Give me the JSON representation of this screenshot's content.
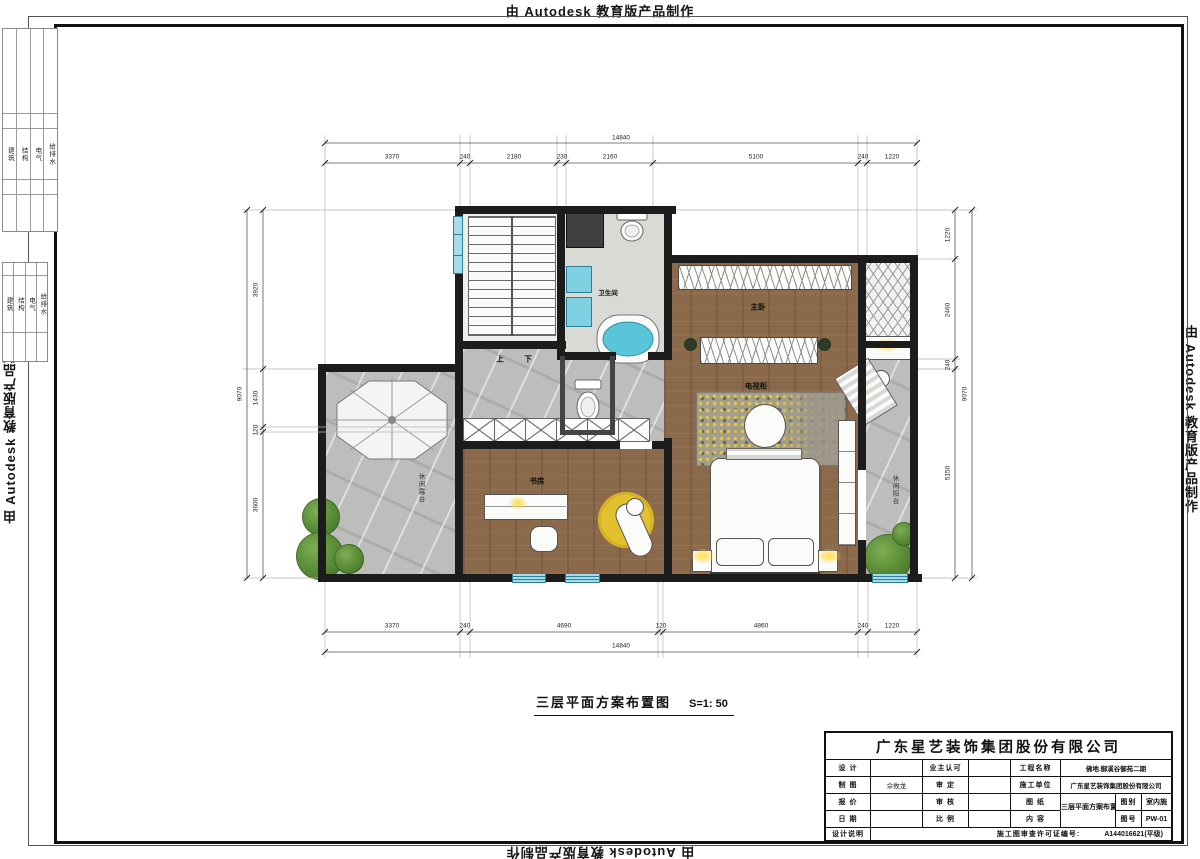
{
  "watermark": "由 Autodesk 教育版产品制作",
  "frame_tables": {
    "disciplines": [
      "建筑",
      "结构",
      "电气",
      "给排水"
    ]
  },
  "drawing_title": {
    "text": "三层平面方案布置图",
    "scale": "S=1: 50"
  },
  "dims": {
    "top": {
      "overall": "14840",
      "segments": [
        "3370",
        "240",
        "2180",
        "230",
        "2160",
        "5100",
        "240",
        "1220"
      ]
    },
    "bottom": {
      "overall": "14840",
      "segments": [
        "3370",
        "240",
        "4690",
        "120",
        "4860",
        "240",
        "1220"
      ]
    },
    "left": {
      "overall": "9070",
      "segments": [
        "3920",
        "1430",
        "120",
        "3600"
      ]
    },
    "right": {
      "overall": "9070",
      "segments": [
        "1220",
        "2460",
        "240",
        "5150"
      ]
    }
  },
  "rooms": {
    "master_bedroom": "主卧",
    "tv_cabinet": "电视柜",
    "study": "书房",
    "bathroom": "卫生间",
    "stair_up": "上",
    "stair_down": "下",
    "terrace": "休闲露台",
    "balcony": "休闲阳台"
  },
  "title_block": {
    "company": "广东星艺装饰集团股份有限公司",
    "design_label": "设 计",
    "draft_label": "制 图",
    "draft_value": "佘攸龙",
    "quote_label": "报 价",
    "date_label": "日 期",
    "notes_label": "设计说明",
    "owner_label": "业主认可",
    "approve_label": "审 定",
    "check_label": "审 核",
    "scale_label": "比 例",
    "project_label": "工程名称",
    "project_value": "佛地.御溪谷御苑二期",
    "contractor_label": "施工单位",
    "contractor_value": "广东星艺装饰集团股份有限公司",
    "sheet_label": "图 纸",
    "content_label": "内 容",
    "sheet_value": "三层平面方案布置图",
    "category_label": "图别",
    "category_value": "室内施",
    "number_label": "图号",
    "number_value": "PW-01",
    "permit_label": "施工图审查许可证编号:",
    "permit_value": "A144016621(平级)"
  },
  "colors": {
    "wall_black": "#1c1c1c",
    "wood_floor": "#8a6a4b",
    "marble_floor": "#bdbdbb",
    "window_glass": "#a5dced",
    "bath_water": "#58c6d8",
    "lamp_glow": "#ffd94a",
    "plant_green": "#5d8f3a",
    "rug_yellow": "#e2c12f"
  }
}
